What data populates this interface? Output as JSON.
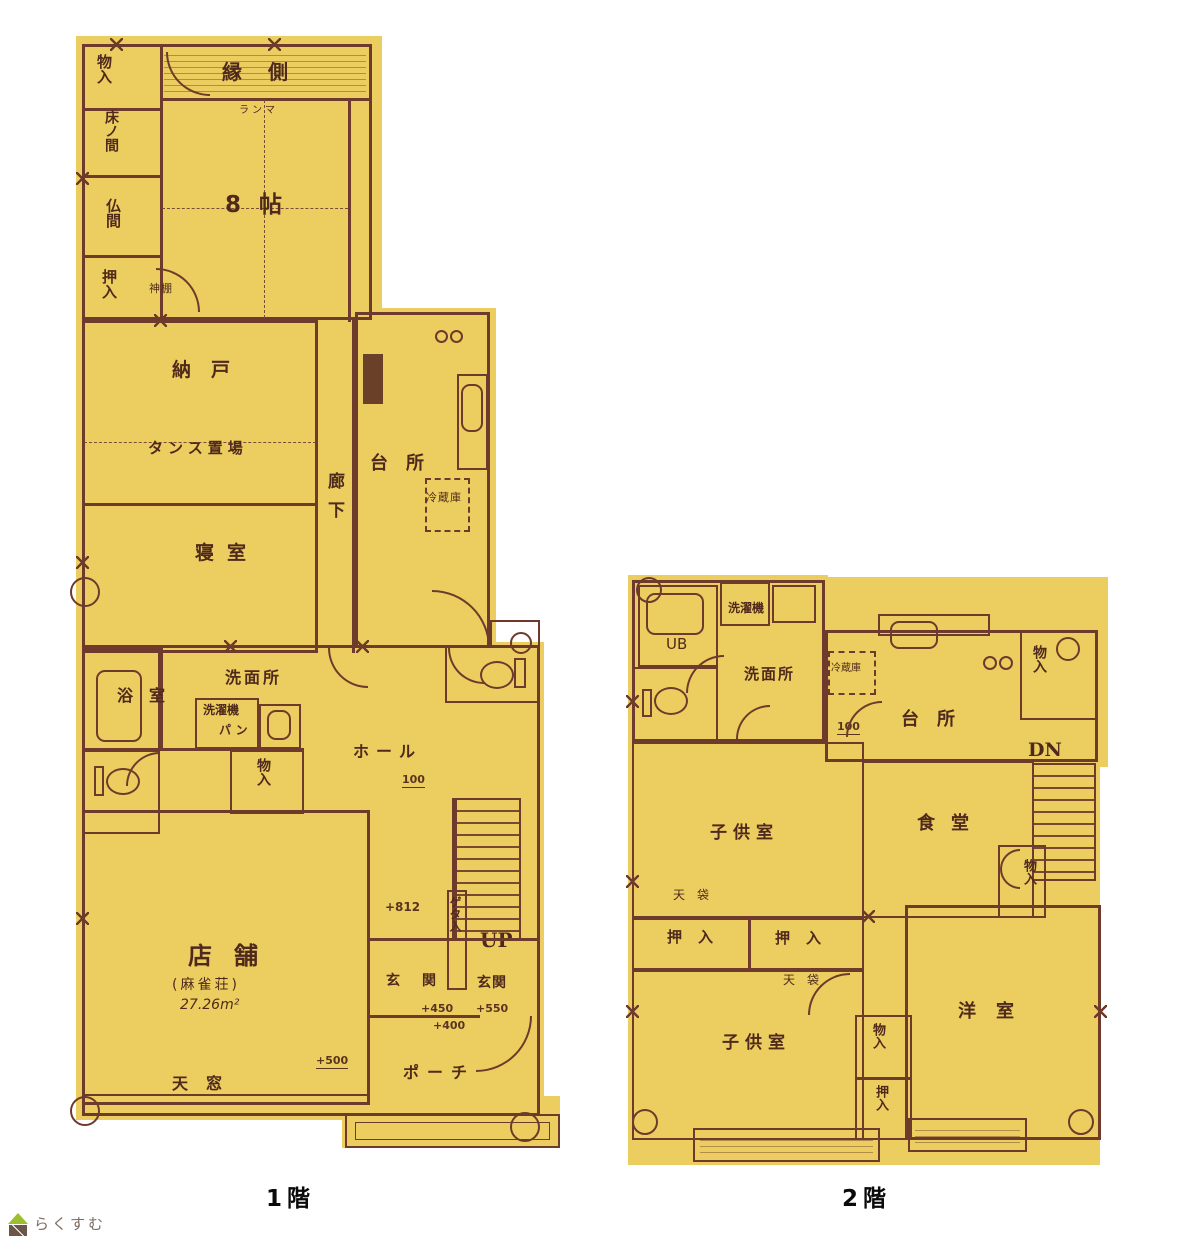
{
  "document_type": "floor-plan-scan",
  "captions": {
    "floor1": "1階",
    "floor2": "2階"
  },
  "logo": {
    "text": "らくすむ",
    "icon": "house-leaf-icon"
  },
  "colors": {
    "paper": "#ecce60",
    "ink": "#6e3a2c",
    "label_text": "#4f2a1c",
    "caption": "#0a0a0a",
    "logo_green": "#9cbf2f",
    "logo_brown": "#6b5648",
    "logo_text": "#7c6c60"
  },
  "floor1": {
    "labels": {
      "monoire_tl": "物入",
      "tokonoma": "床ノ間",
      "butsuma": "仏間",
      "oshiire_tl": "押入",
      "engawa": "縁側",
      "ranma": "ランマ",
      "hachijo": "8帖",
      "kamidana": "神棚",
      "nando": "納戸",
      "tansu_okiba": "タンス置場",
      "shinshitsu": "寝室",
      "rouka": "廊下",
      "daidokoro": "台所",
      "reizouko": "冷蔵庫",
      "senmenjo": "洗面所",
      "sentakuki": "洗濯機",
      "pan": "パン",
      "yokushitsu": "浴室",
      "monoire_hall": "物入",
      "hall": "ホール",
      "dim100": "100",
      "tenpo": "店舗",
      "tenpo_note": "(麻雀荘)",
      "tenpo_area": "27.26m²",
      "tenmado": "天窓",
      "dim812": "+812",
      "up": "UP",
      "geta": "ゲタ入",
      "genkan_a": "玄関",
      "genkan_b": "玄関",
      "dim450": "+450",
      "dim550": "+550",
      "dim400": "+400",
      "dim500": "+500",
      "porch": "ポーチ"
    }
  },
  "floor2": {
    "labels": {
      "ub": "UB",
      "sentakuki": "洗濯機",
      "senmenjo": "洗面所",
      "reizouko": "冷蔵庫",
      "daidokoro": "台所",
      "monoire_tr": "物入",
      "dn": "DN",
      "dim100": "100",
      "kodomo_1": "子供室",
      "shokudo": "食堂",
      "monoire_mid": "物入",
      "tenbukuro_1": "天袋",
      "oshiire_1": "押入",
      "oshiire_2": "押入",
      "tenbukuro_2": "天袋",
      "youshitsu": "洋室",
      "kodomo_2": "子供室",
      "monoire_b": "物入",
      "oshiire_b": "押入"
    }
  }
}
